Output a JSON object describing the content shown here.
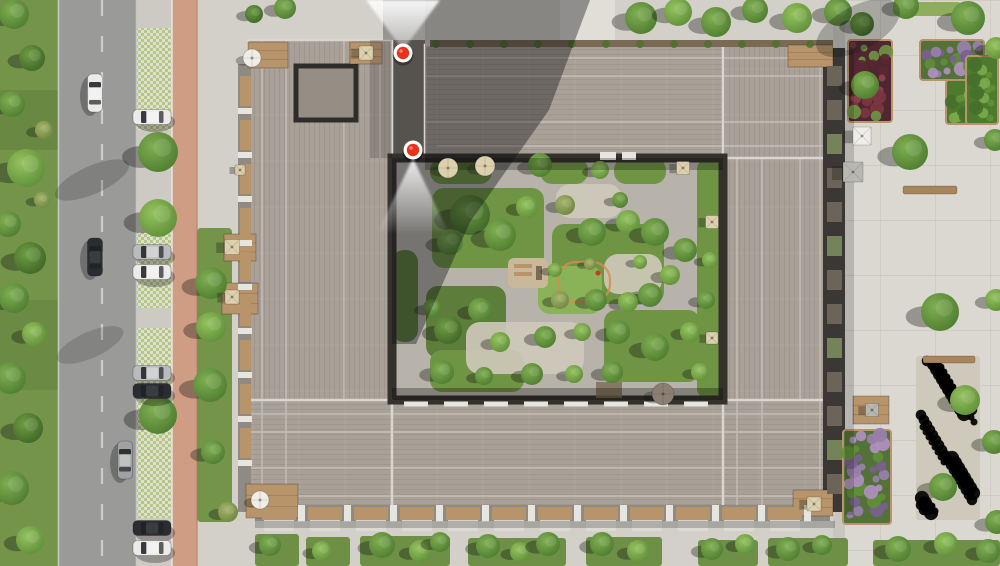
{
  "scene": {
    "width": 1000,
    "height": 566
  },
  "palette": {
    "grass": "#74944a",
    "grass_dark": "#5d7c3a",
    "road": "#9a9a98",
    "road_edge": "#c8c8c4",
    "lane_line": "#d8d8d4",
    "parking_base": "#cdcac3",
    "paver_green": "#b5c787",
    "paver_light": "#dfe0d0",
    "bike_path": "#cf9c84",
    "bike_edge": "#b8876e",
    "sidewalk": "#d3d0c9",
    "crossing": "#e1ded7",
    "plaza": "#dbd8d1",
    "plaza_line": "#c6c3bc",
    "plaza_inner": "#c9c6bf",
    "roof": "#a9a097",
    "roof_seam": "#c9c4bd",
    "roof_edge": "#dad6cf",
    "roof_dark": "#968d84",
    "recess_dark": "#2e2d2b",
    "passage": "#56534e",
    "facade_dark": "#3a3734",
    "facade_wood_strip": "#7a6a54",
    "facade_mid": "#8f8a83",
    "balcony_slot": "#6d6459",
    "balcony_plant": "#74835a",
    "wood": "#b8946a",
    "deck_white": "#e7e5e0",
    "patio_white": "#dcdad4",
    "courtyard": "#b7b3ab",
    "gravel": "#cfc9bb",
    "lawn": "#6f9444",
    "lawn_bright": "#8ab257",
    "lawn_dark": "#5d7d3a",
    "hedge": "#8fae5c",
    "shadow": "rgba(12,14,18,0.38)",
    "shadow_soft": "rgba(12,14,18,0.22)",
    "marker_red": "#e8331c",
    "marker_ring": "#ffffff",
    "car_white": "#ebebe9",
    "car_silver": "#b9bbbc",
    "car_black": "#2b2d30",
    "car_gray": "#9fa1a2",
    "glass_dark": "#1e2126",
    "umb_beige": "#ddd0ae",
    "umb_white": "#efede8",
    "umb_gray": "#b9b7b2",
    "umb_taupe": "#8a7f72",
    "playground_sand": "#c9b99a",
    "playground_loop": "#d98a4f",
    "accent_red": "#c43b22",
    "bed_green_base": "#4e7a2e",
    "bed_purple_base": "#55713a",
    "bed_crimson_base": "#4f2730",
    "bench_wood": "#a8855c"
  },
  "markers": [
    {
      "id": "marker-top-entrance",
      "x": 403,
      "y": 53,
      "beam": {
        "dir": "up",
        "apex_x": 403,
        "apex_y": 50,
        "base_y": 0,
        "x_left": 366,
        "x_right": 440
      }
    },
    {
      "id": "marker-courtyard",
      "x": 413,
      "y": 150,
      "beam": {
        "dir": "down",
        "apex_x": 413,
        "apex_y": 158,
        "base_y": 232,
        "x_left": 378,
        "x_right": 448
      }
    }
  ],
  "cars": [
    {
      "x": 95,
      "y": 93,
      "orient": "v",
      "color": "car_white",
      "kind": "driving"
    },
    {
      "x": 95,
      "y": 257,
      "orient": "v",
      "color": "car_black",
      "kind": "driving"
    },
    {
      "x": 125,
      "y": 460,
      "orient": "v",
      "color": "car_gray",
      "kind": "driving"
    },
    {
      "x": 152,
      "y": 117,
      "orient": "h",
      "color": "car_white",
      "kind": "parked"
    },
    {
      "x": 152,
      "y": 252,
      "orient": "h",
      "color": "car_silver",
      "kind": "parked"
    },
    {
      "x": 152,
      "y": 272,
      "orient": "h",
      "color": "car_white",
      "kind": "parked"
    },
    {
      "x": 152,
      "y": 373,
      "orient": "h",
      "color": "car_silver",
      "kind": "parked"
    },
    {
      "x": 152,
      "y": 391,
      "orient": "h",
      "color": "car_black",
      "kind": "parked"
    },
    {
      "x": 152,
      "y": 528,
      "orient": "h",
      "color": "car_black",
      "kind": "parked"
    },
    {
      "x": 152,
      "y": 548,
      "orient": "h",
      "color": "car_white",
      "kind": "parked"
    }
  ],
  "trees": [
    {
      "x": 14,
      "y": 14,
      "r": 15,
      "t": "mid"
    },
    {
      "x": 32,
      "y": 58,
      "r": 13,
      "t": "dark"
    },
    {
      "x": 12,
      "y": 104,
      "r": 13,
      "t": "mid"
    },
    {
      "x": 26,
      "y": 168,
      "r": 19,
      "t": "light"
    },
    {
      "x": 8,
      "y": 224,
      "r": 13,
      "t": "mid"
    },
    {
      "x": 30,
      "y": 258,
      "r": 16,
      "t": "dark"
    },
    {
      "x": 14,
      "y": 298,
      "r": 15,
      "t": "mid"
    },
    {
      "x": 34,
      "y": 334,
      "r": 12,
      "t": "light"
    },
    {
      "x": 10,
      "y": 378,
      "r": 16,
      "t": "mid"
    },
    {
      "x": 28,
      "y": 428,
      "r": 15,
      "t": "dark"
    },
    {
      "x": 12,
      "y": 488,
      "r": 17,
      "t": "mid"
    },
    {
      "x": 30,
      "y": 540,
      "r": 14,
      "t": "light"
    },
    {
      "x": 44,
      "y": 130,
      "r": 9,
      "t": "olive"
    },
    {
      "x": 42,
      "y": 200,
      "r": 8,
      "t": "olive"
    },
    {
      "x": 158,
      "y": 152,
      "r": 20,
      "t": "mid"
    },
    {
      "x": 158,
      "y": 218,
      "r": 19,
      "t": "light"
    },
    {
      "x": 158,
      "y": 415,
      "r": 19,
      "t": "mid"
    },
    {
      "x": 211,
      "y": 283,
      "r": 16,
      "t": "mid"
    },
    {
      "x": 211,
      "y": 327,
      "r": 15,
      "t": "light"
    },
    {
      "x": 210,
      "y": 385,
      "r": 17,
      "t": "mid"
    },
    {
      "x": 213,
      "y": 452,
      "r": 12,
      "t": "mid"
    },
    {
      "x": 228,
      "y": 512,
      "r": 10,
      "t": "olive"
    },
    {
      "x": 254,
      "y": 14,
      "r": 9,
      "t": "dark"
    },
    {
      "x": 285,
      "y": 8,
      "r": 11,
      "t": "mid"
    },
    {
      "x": 641,
      "y": 18,
      "r": 16,
      "t": "mid"
    },
    {
      "x": 678,
      "y": 12,
      "r": 14,
      "t": "light"
    },
    {
      "x": 716,
      "y": 22,
      "r": 15,
      "t": "mid"
    },
    {
      "x": 755,
      "y": 10,
      "r": 13,
      "t": "mid"
    },
    {
      "x": 797,
      "y": 18,
      "r": 15,
      "t": "light"
    },
    {
      "x": 838,
      "y": 12,
      "r": 14,
      "t": "mid"
    },
    {
      "x": 862,
      "y": 24,
      "r": 12,
      "t": "dark"
    },
    {
      "x": 906,
      "y": 6,
      "r": 13,
      "t": "mid"
    },
    {
      "x": 968,
      "y": 18,
      "r": 17,
      "t": "mid"
    },
    {
      "x": 996,
      "y": 48,
      "r": 11,
      "t": "light"
    },
    {
      "x": 865,
      "y": 85,
      "r": 14,
      "t": "mid"
    },
    {
      "x": 910,
      "y": 152,
      "r": 18,
      "t": "mid"
    },
    {
      "x": 940,
      "y": 312,
      "r": 19,
      "t": "mid"
    },
    {
      "x": 965,
      "y": 400,
      "r": 15,
      "t": "light"
    },
    {
      "x": 943,
      "y": 487,
      "r": 14,
      "t": "mid"
    },
    {
      "x": 995,
      "y": 140,
      "r": 11,
      "t": "mid"
    },
    {
      "x": 996,
      "y": 300,
      "r": 11,
      "t": "light"
    },
    {
      "x": 994,
      "y": 442,
      "r": 12,
      "t": "mid"
    },
    {
      "x": 997,
      "y": 522,
      "r": 12,
      "t": "mid"
    },
    {
      "x": 470,
      "y": 215,
      "r": 20,
      "t": "dark"
    },
    {
      "x": 500,
      "y": 235,
      "r": 16,
      "t": "mid"
    },
    {
      "x": 450,
      "y": 242,
      "r": 13,
      "t": "mid"
    },
    {
      "x": 527,
      "y": 207,
      "r": 11,
      "t": "light"
    },
    {
      "x": 540,
      "y": 165,
      "r": 12,
      "t": "mid"
    },
    {
      "x": 600,
      "y": 170,
      "r": 9,
      "t": "light"
    },
    {
      "x": 565,
      "y": 205,
      "r": 10,
      "t": "olive"
    },
    {
      "x": 620,
      "y": 200,
      "r": 8,
      "t": "mid"
    },
    {
      "x": 592,
      "y": 232,
      "r": 14,
      "t": "mid"
    },
    {
      "x": 628,
      "y": 222,
      "r": 12,
      "t": "light"
    },
    {
      "x": 655,
      "y": 232,
      "r": 14,
      "t": "mid"
    },
    {
      "x": 685,
      "y": 250,
      "r": 12,
      "t": "mid"
    },
    {
      "x": 670,
      "y": 275,
      "r": 10,
      "t": "light"
    },
    {
      "x": 650,
      "y": 295,
      "r": 12,
      "t": "mid"
    },
    {
      "x": 628,
      "y": 302,
      "r": 10,
      "t": "light"
    },
    {
      "x": 596,
      "y": 300,
      "r": 11,
      "t": "mid"
    },
    {
      "x": 560,
      "y": 300,
      "r": 9,
      "t": "olive"
    },
    {
      "x": 480,
      "y": 310,
      "r": 12,
      "t": "mid"
    },
    {
      "x": 448,
      "y": 330,
      "r": 14,
      "t": "dark"
    },
    {
      "x": 432,
      "y": 308,
      "r": 9,
      "t": "mid"
    },
    {
      "x": 500,
      "y": 342,
      "r": 10,
      "t": "light"
    },
    {
      "x": 545,
      "y": 337,
      "r": 11,
      "t": "mid"
    },
    {
      "x": 582,
      "y": 332,
      "r": 9,
      "t": "light"
    },
    {
      "x": 618,
      "y": 332,
      "r": 12,
      "t": "mid"
    },
    {
      "x": 655,
      "y": 347,
      "r": 14,
      "t": "mid"
    },
    {
      "x": 690,
      "y": 332,
      "r": 10,
      "t": "light"
    },
    {
      "x": 612,
      "y": 372,
      "r": 11,
      "t": "mid"
    },
    {
      "x": 574,
      "y": 374,
      "r": 9,
      "t": "light"
    },
    {
      "x": 532,
      "y": 374,
      "r": 11,
      "t": "mid"
    },
    {
      "x": 484,
      "y": 376,
      "r": 9,
      "t": "mid"
    },
    {
      "x": 442,
      "y": 372,
      "r": 12,
      "t": "mid"
    },
    {
      "x": 700,
      "y": 372,
      "r": 9,
      "t": "light"
    },
    {
      "x": 706,
      "y": 300,
      "r": 9,
      "t": "mid"
    },
    {
      "x": 710,
      "y": 260,
      "r": 8,
      "t": "light"
    },
    {
      "x": 555,
      "y": 270,
      "r": 7,
      "t": "light"
    },
    {
      "x": 590,
      "y": 264,
      "r": 6,
      "t": "olive"
    },
    {
      "x": 640,
      "y": 262,
      "r": 7,
      "t": "light"
    },
    {
      "x": 270,
      "y": 545,
      "r": 11,
      "t": "mid"
    },
    {
      "x": 322,
      "y": 551,
      "r": 10,
      "t": "light"
    },
    {
      "x": 382,
      "y": 545,
      "r": 13,
      "t": "mid"
    },
    {
      "x": 420,
      "y": 551,
      "r": 11,
      "t": "light"
    },
    {
      "x": 440,
      "y": 542,
      "r": 10,
      "t": "mid"
    },
    {
      "x": 488,
      "y": 546,
      "r": 12,
      "t": "mid"
    },
    {
      "x": 520,
      "y": 552,
      "r": 10,
      "t": "light"
    },
    {
      "x": 548,
      "y": 544,
      "r": 12,
      "t": "mid"
    },
    {
      "x": 602,
      "y": 544,
      "r": 12,
      "t": "mid"
    },
    {
      "x": 638,
      "y": 551,
      "r": 11,
      "t": "light"
    },
    {
      "x": 712,
      "y": 549,
      "r": 11,
      "t": "mid"
    },
    {
      "x": 745,
      "y": 544,
      "r": 10,
      "t": "light"
    },
    {
      "x": 788,
      "y": 549,
      "r": 12,
      "t": "mid"
    },
    {
      "x": 822,
      "y": 545,
      "r": 10,
      "t": "mid"
    },
    {
      "x": 898,
      "y": 549,
      "r": 13,
      "t": "mid"
    },
    {
      "x": 946,
      "y": 544,
      "r": 12,
      "t": "light"
    },
    {
      "x": 988,
      "y": 551,
      "r": 12,
      "t": "mid"
    }
  ],
  "umbrellas": [
    {
      "type": "round",
      "x": 252,
      "y": 58,
      "r": 9,
      "c": "umb_white"
    },
    {
      "type": "square",
      "x": 366,
      "y": 53,
      "s": 14,
      "c": "umb_beige"
    },
    {
      "type": "round",
      "x": 448,
      "y": 168,
      "r": 10,
      "c": "umb_beige"
    },
    {
      "type": "round",
      "x": 485,
      "y": 166,
      "r": 10,
      "c": "umb_beige"
    },
    {
      "type": "square",
      "x": 683,
      "y": 168,
      "s": 13,
      "c": "umb_beige"
    },
    {
      "type": "square",
      "x": 712,
      "y": 222,
      "s": 13,
      "c": "umb_beige"
    },
    {
      "type": "square",
      "x": 712,
      "y": 338,
      "s": 12,
      "c": "umb_beige"
    },
    {
      "type": "square",
      "x": 232,
      "y": 247,
      "s": 15,
      "c": "umb_beige"
    },
    {
      "type": "square",
      "x": 232,
      "y": 297,
      "s": 14,
      "c": "umb_beige"
    },
    {
      "type": "round",
      "x": 260,
      "y": 500,
      "r": 9,
      "c": "umb_white"
    },
    {
      "type": "square",
      "x": 814,
      "y": 504,
      "s": 14,
      "c": "umb_beige"
    },
    {
      "type": "square",
      "x": 862,
      "y": 136,
      "s": 18,
      "c": "umb_white"
    },
    {
      "type": "square",
      "x": 853,
      "y": 172,
      "s": 20,
      "c": "umb_gray"
    },
    {
      "type": "square",
      "x": 872,
      "y": 410,
      "s": 13,
      "c": "umb_gray"
    },
    {
      "type": "round",
      "x": 663,
      "y": 394,
      "r": 11,
      "c": "umb_taupe"
    },
    {
      "type": "square",
      "x": 240,
      "y": 170,
      "s": 10,
      "c": "umb_beige"
    }
  ],
  "decks": [
    {
      "x": 248,
      "y": 42,
      "w": 40,
      "h": 26
    },
    {
      "x": 350,
      "y": 42,
      "w": 32,
      "h": 22
    },
    {
      "x": 788,
      "y": 45,
      "w": 45,
      "h": 22
    },
    {
      "x": 793,
      "y": 490,
      "w": 40,
      "h": 26
    },
    {
      "x": 246,
      "y": 484,
      "w": 52,
      "h": 34
    },
    {
      "x": 224,
      "y": 234,
      "w": 32,
      "h": 27
    },
    {
      "x": 222,
      "y": 283,
      "w": 36,
      "h": 31
    },
    {
      "x": 853,
      "y": 396,
      "w": 36,
      "h": 28
    }
  ],
  "benches": [
    {
      "x": 903,
      "y": 186,
      "w": 54,
      "h": 8
    },
    {
      "x": 923,
      "y": 356,
      "w": 52,
      "h": 7
    }
  ],
  "beds": [
    {
      "x": 848,
      "y": 40,
      "w": 44,
      "h": 82,
      "type": "crimson"
    },
    {
      "x": 920,
      "y": 40,
      "w": 64,
      "h": 40,
      "type": "purple"
    },
    {
      "x": 946,
      "y": 80,
      "w": 52,
      "h": 44,
      "type": "green"
    },
    {
      "x": 966,
      "y": 56,
      "w": 32,
      "h": 68,
      "type": "green"
    },
    {
      "x": 843,
      "y": 430,
      "w": 48,
      "h": 94,
      "type": "purple"
    },
    {
      "x": 916,
      "y": 356,
      "w": 64,
      "h": 164,
      "type": "gravel"
    }
  ],
  "bottom_beds": [
    {
      "x": 255,
      "y": 534,
      "w": 44,
      "h": 32
    },
    {
      "x": 306,
      "y": 537,
      "w": 44,
      "h": 29
    },
    {
      "x": 360,
      "y": 536,
      "w": 90,
      "h": 30
    },
    {
      "x": 468,
      "y": 538,
      "w": 98,
      "h": 28
    },
    {
      "x": 586,
      "y": 537,
      "w": 76,
      "h": 29
    },
    {
      "x": 698,
      "y": 540,
      "w": 60,
      "h": 26
    },
    {
      "x": 768,
      "y": 538,
      "w": 80,
      "h": 28
    },
    {
      "x": 873,
      "y": 540,
      "w": 127,
      "h": 26
    }
  ],
  "lawns": [
    {
      "x": 432,
      "y": 188,
      "w": 112,
      "h": 80,
      "c": "lawn"
    },
    {
      "x": 552,
      "y": 224,
      "w": 112,
      "h": 80,
      "c": "lawn"
    },
    {
      "x": 538,
      "y": 266,
      "w": 64,
      "h": 48,
      "c": "lawn_bright"
    },
    {
      "x": 604,
      "y": 310,
      "w": 96,
      "h": 72,
      "c": "lawn"
    },
    {
      "x": 426,
      "y": 286,
      "w": 80,
      "h": 72,
      "c": "lawn_dark"
    },
    {
      "x": 430,
      "y": 350,
      "w": 94,
      "h": 42,
      "c": "lawn"
    },
    {
      "x": 430,
      "y": 158,
      "w": 62,
      "h": 26,
      "c": "lawn"
    },
    {
      "x": 540,
      "y": 158,
      "w": 48,
      "h": 26,
      "c": "lawn"
    },
    {
      "x": 614,
      "y": 158,
      "w": 52,
      "h": 26,
      "c": "lawn"
    },
    {
      "x": 697,
      "y": 158,
      "w": 26,
      "h": 242,
      "c": "lawn"
    },
    {
      "x": 392,
      "y": 250,
      "w": 26,
      "h": 92,
      "c": "lawn_dark"
    }
  ],
  "gravel_patches": [
    {
      "x": 466,
      "y": 322,
      "w": 118,
      "h": 52
    },
    {
      "x": 556,
      "y": 184,
      "w": 66,
      "h": 34
    },
    {
      "x": 604,
      "y": 254,
      "w": 58,
      "h": 40
    }
  ]
}
